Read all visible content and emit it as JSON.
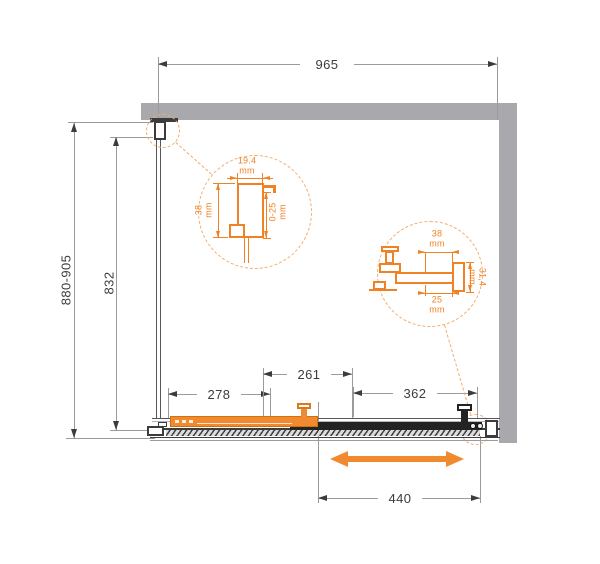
{
  "dimensions": {
    "overall_width": "965",
    "overall_height": "880-905",
    "glass_height": "832",
    "fixed_segment": "278",
    "middle_segment": "261",
    "door_segment": "362",
    "slide_travel": "440"
  },
  "detail_left": {
    "profile_width": "19.4",
    "profile_width_unit": "mm",
    "profile_depth": "38",
    "profile_depth_unit": "mm",
    "adjustment_range": "0-25",
    "adjustment_range_unit": "mm"
  },
  "detail_right": {
    "profile_width": "38",
    "profile_width_unit": "mm",
    "profile_height": "31,4",
    "profile_height_unit": "mm",
    "inner_width": "25",
    "inner_width_unit": "mm"
  },
  "colors": {
    "accent_orange": "#EF8224",
    "wall_gray": "#A9A9AD",
    "line_dark": "#3C3C3E",
    "dim_gray": "#9B9B9B"
  }
}
